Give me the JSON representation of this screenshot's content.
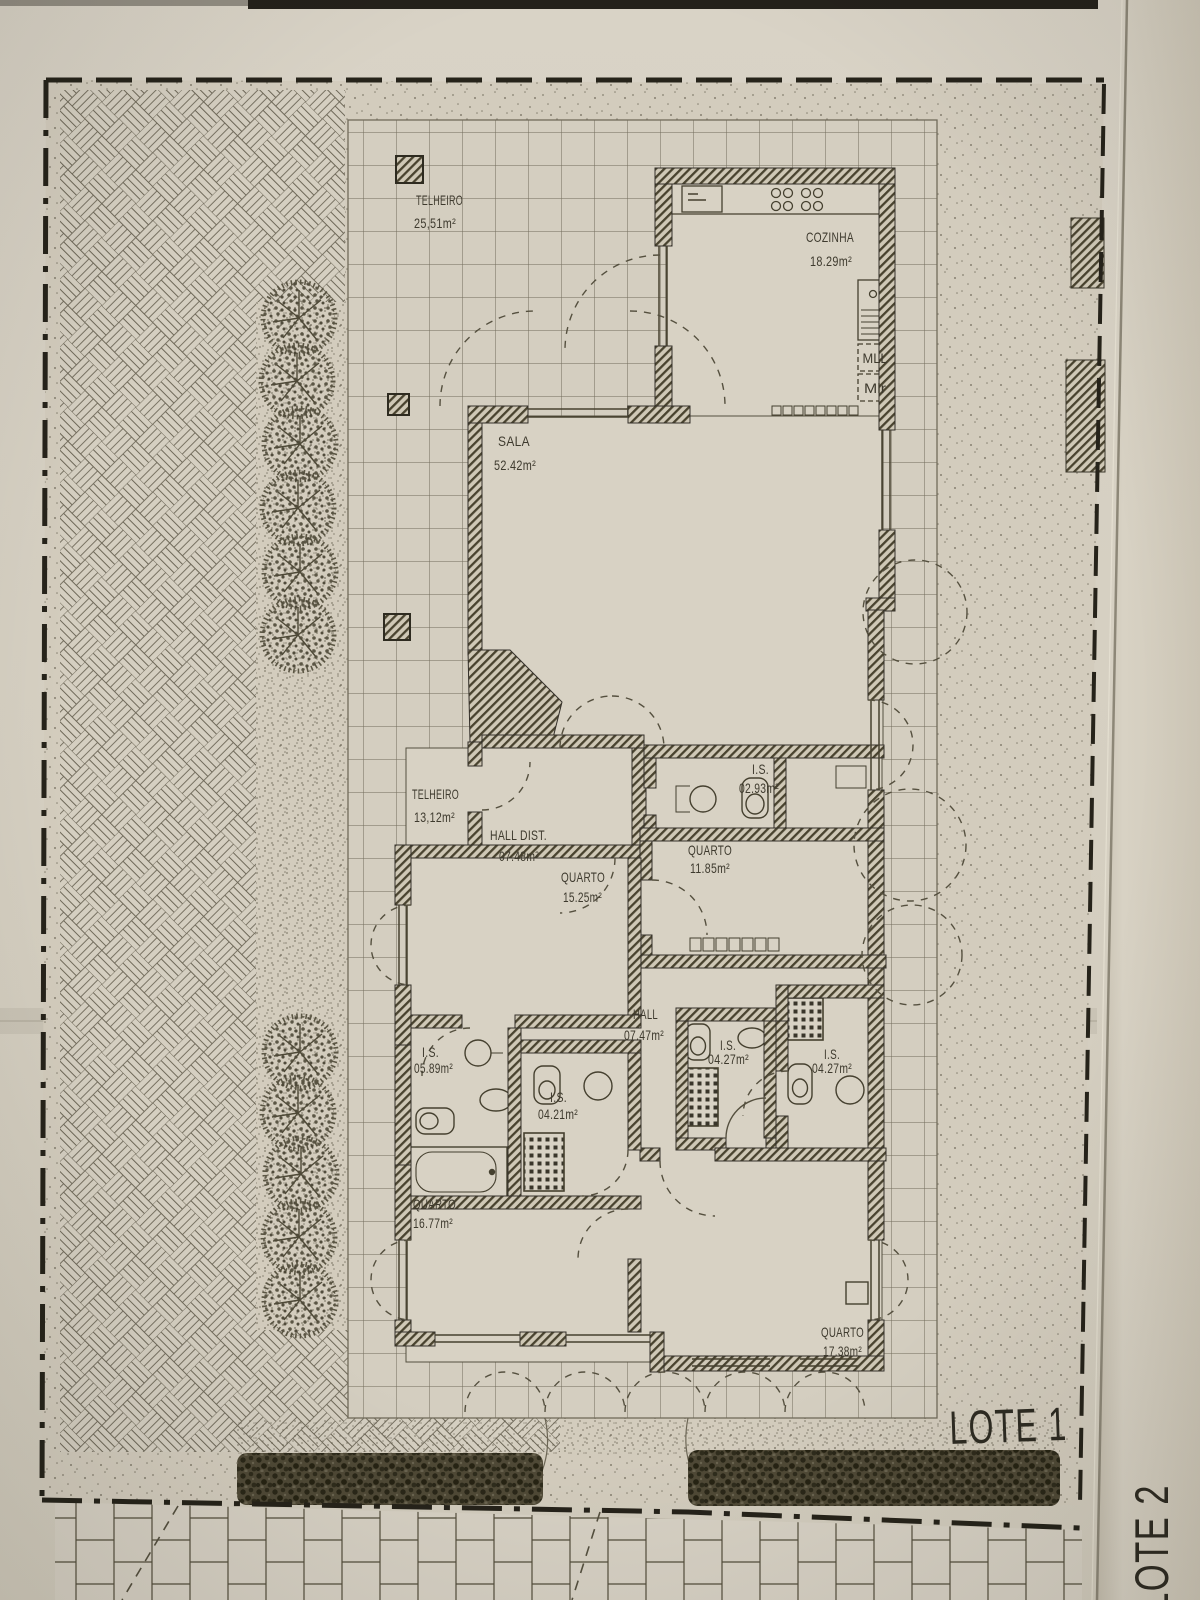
{
  "plan": {
    "rooms": [
      {
        "name": "TELHEIRO",
        "area": "25,51m²"
      },
      {
        "name": "COZINHA",
        "area": "18.29m²"
      },
      {
        "name": "SALA",
        "area": "52.42m²"
      },
      {
        "name": "TELHEIRO",
        "area": "13,12m²"
      },
      {
        "name": "HALL DIST.",
        "area": "07.48m²"
      },
      {
        "name": "I.S.",
        "area": "02.93m²"
      },
      {
        "name": "QUARTO",
        "area": "11.85m²"
      },
      {
        "name": "QUARTO",
        "area": "15.25m²"
      },
      {
        "name": "HALL",
        "area": "07.47m²"
      },
      {
        "name": "I.S.",
        "area": "05.89m²"
      },
      {
        "name": "I.S.",
        "area": "04.21m²"
      },
      {
        "name": "I.S.",
        "area": "04.27m²"
      },
      {
        "name": "I.S.",
        "area": "04.27m²"
      },
      {
        "name": "QUARTO",
        "area": "16.77m²"
      },
      {
        "name": "QUARTO",
        "area": "17.38m²"
      }
    ],
    "appliances": {
      "mll": "MLL",
      "mlr": "Mlr"
    },
    "lots": {
      "lote1": "LOTE 1",
      "lote2": "LOTE 2"
    },
    "colors": {
      "ink": "#3e3a2e",
      "paper": "#d6d0c2"
    }
  }
}
